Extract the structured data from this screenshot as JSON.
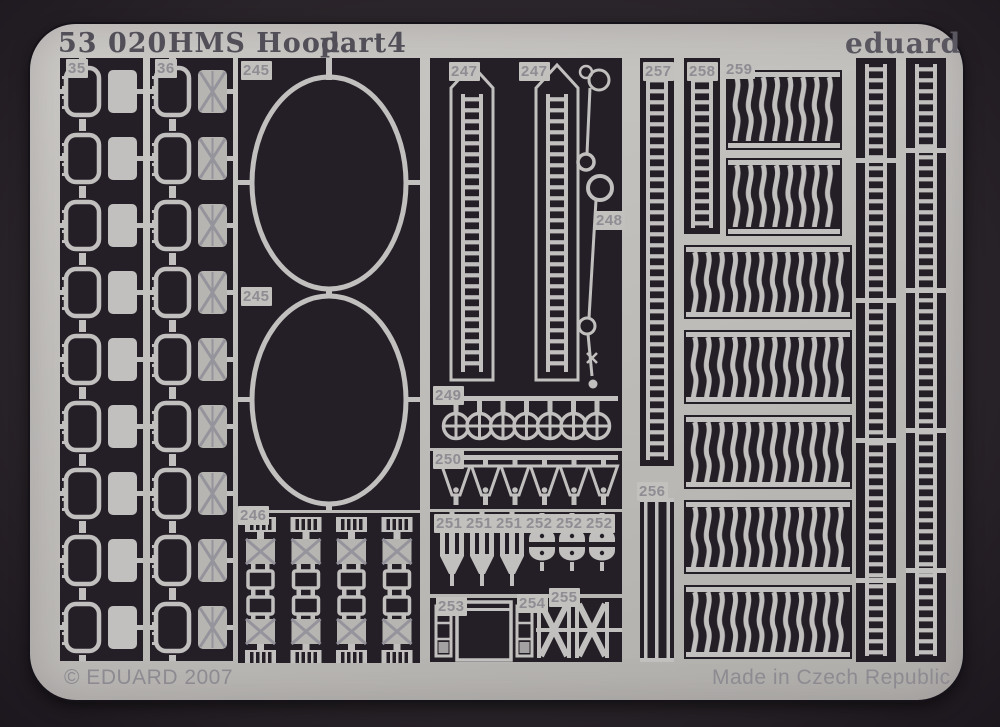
{
  "header": {
    "catalog": "53 020",
    "kit": "HMS Hood",
    "part": "part4",
    "brand": "eduard"
  },
  "footer": {
    "copyright": "© EDUARD 2007",
    "made_in": "Made in Czech Republic"
  },
  "labels": {
    "p35": "35",
    "p36": "36",
    "p245": "245",
    "p246": "246",
    "p247": "247",
    "p248": "248",
    "p249": "249",
    "p250": "250",
    "p251": "251",
    "p252": "252",
    "p253": "253",
    "p254": "254",
    "p255": "255",
    "p256": "256",
    "p257": "257",
    "p258": "258",
    "p259": "259"
  },
  "colors": {
    "bg": "#292429",
    "sheet": "#c0beba",
    "cutout": "#241f27",
    "etch": "#c2c0be",
    "title-text": "#524f59",
    "label-text": "#8f8d93",
    "footer-text": "#8d8b91"
  }
}
